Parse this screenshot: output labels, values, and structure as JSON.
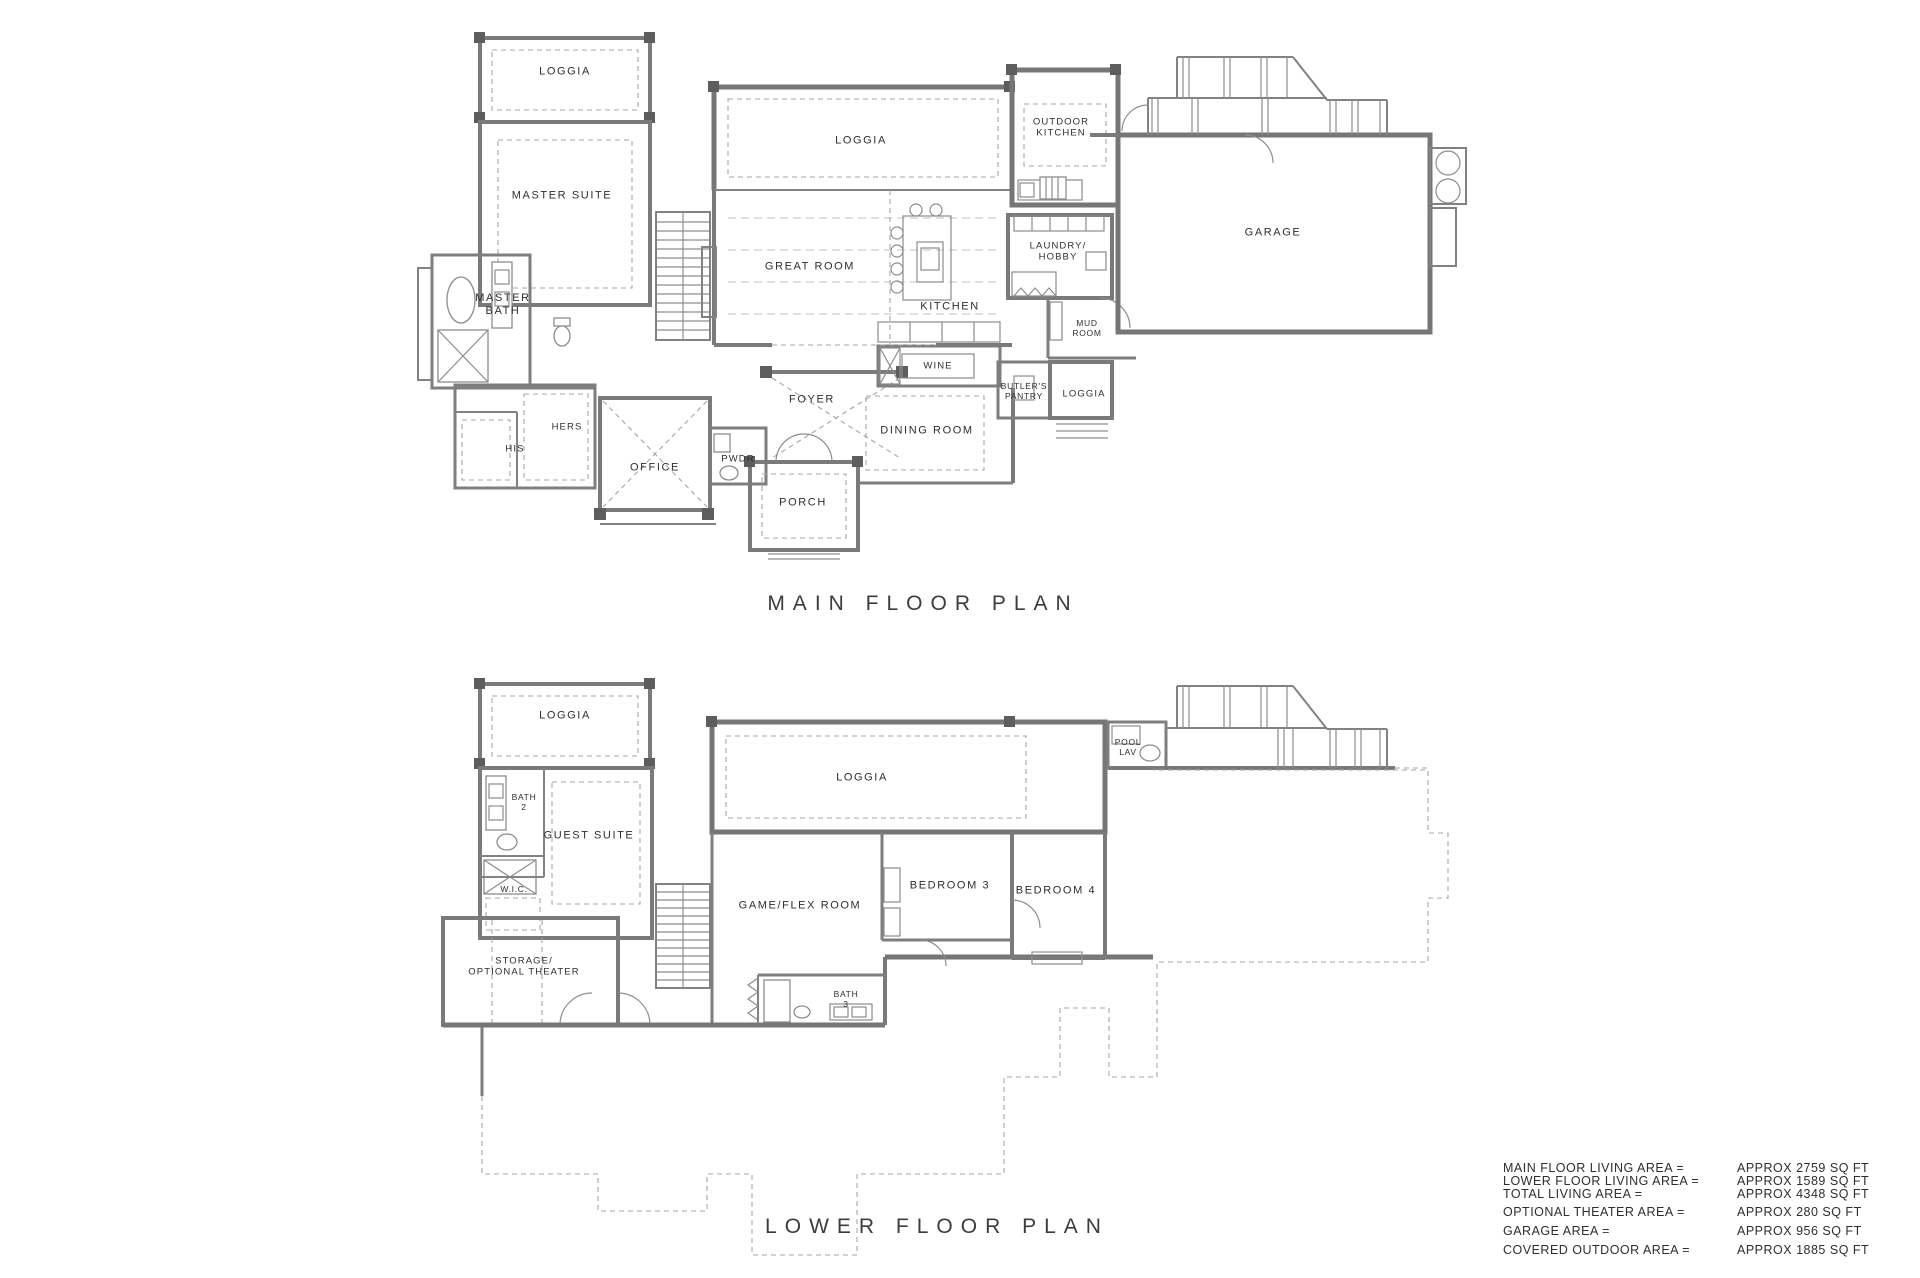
{
  "sheet": {
    "background": "#ffffff",
    "wall_color": "#7a7a7a",
    "dashed_color": "#a6a6a6",
    "text_color": "#2e2e2e"
  },
  "main_floor": {
    "title": "MAIN FLOOR PLAN",
    "rooms": [
      {
        "label": "LOGGIA"
      },
      {
        "label": "MASTER SUITE"
      },
      {
        "label": "MASTER\nBATH"
      },
      {
        "label": "HIS"
      },
      {
        "label": "HERS"
      },
      {
        "label": "OFFICE"
      },
      {
        "label": "PWDR"
      },
      {
        "label": "FOYER"
      },
      {
        "label": "PORCH"
      },
      {
        "label": "DINING ROOM"
      },
      {
        "label": "WINE"
      },
      {
        "label": "LOGGIA"
      },
      {
        "label": "GREAT ROOM"
      },
      {
        "label": "KITCHEN"
      },
      {
        "label": "OUTDOOR\nKITCHEN"
      },
      {
        "label": "LAUNDRY/\nHOBBY"
      },
      {
        "label": "MUD\nROOM"
      },
      {
        "label": "BUTLER'S\nPANTRY"
      },
      {
        "label": "LOGGIA"
      },
      {
        "label": "GARAGE"
      }
    ]
  },
  "lower_floor": {
    "title": "LOWER FLOOR PLAN",
    "rooms": [
      {
        "label": "LOGGIA"
      },
      {
        "label": "BATH\n2"
      },
      {
        "label": "GUEST SUITE"
      },
      {
        "label": "W.I.C."
      },
      {
        "label": "STORAGE/\nOPTIONAL THEATER"
      },
      {
        "label": "LOGGIA"
      },
      {
        "label": "GAME/FLEX ROOM"
      },
      {
        "label": "BEDROOM 3"
      },
      {
        "label": "BEDROOM 4"
      },
      {
        "label": "BATH\n3"
      },
      {
        "label": "POOL\nLAV"
      }
    ]
  },
  "area_summary": {
    "rows": [
      {
        "label": "MAIN FLOOR LIVING AREA =",
        "value": "APPROX 2759 SQ FT"
      },
      {
        "label": "LOWER FLOOR LIVING AREA =",
        "value": "APPROX 1589 SQ FT"
      },
      {
        "label": "TOTAL LIVING AREA =",
        "value": "APPROX 4348 SQ FT"
      },
      {
        "label": "OPTIONAL THEATER AREA =",
        "value": "APPROX 280 SQ FT"
      },
      {
        "label": "GARAGE AREA =",
        "value": "APPROX 956 SQ FT"
      },
      {
        "label": "COVERED OUTDOOR AREA =",
        "value": "APPROX 1885 SQ FT"
      }
    ]
  }
}
